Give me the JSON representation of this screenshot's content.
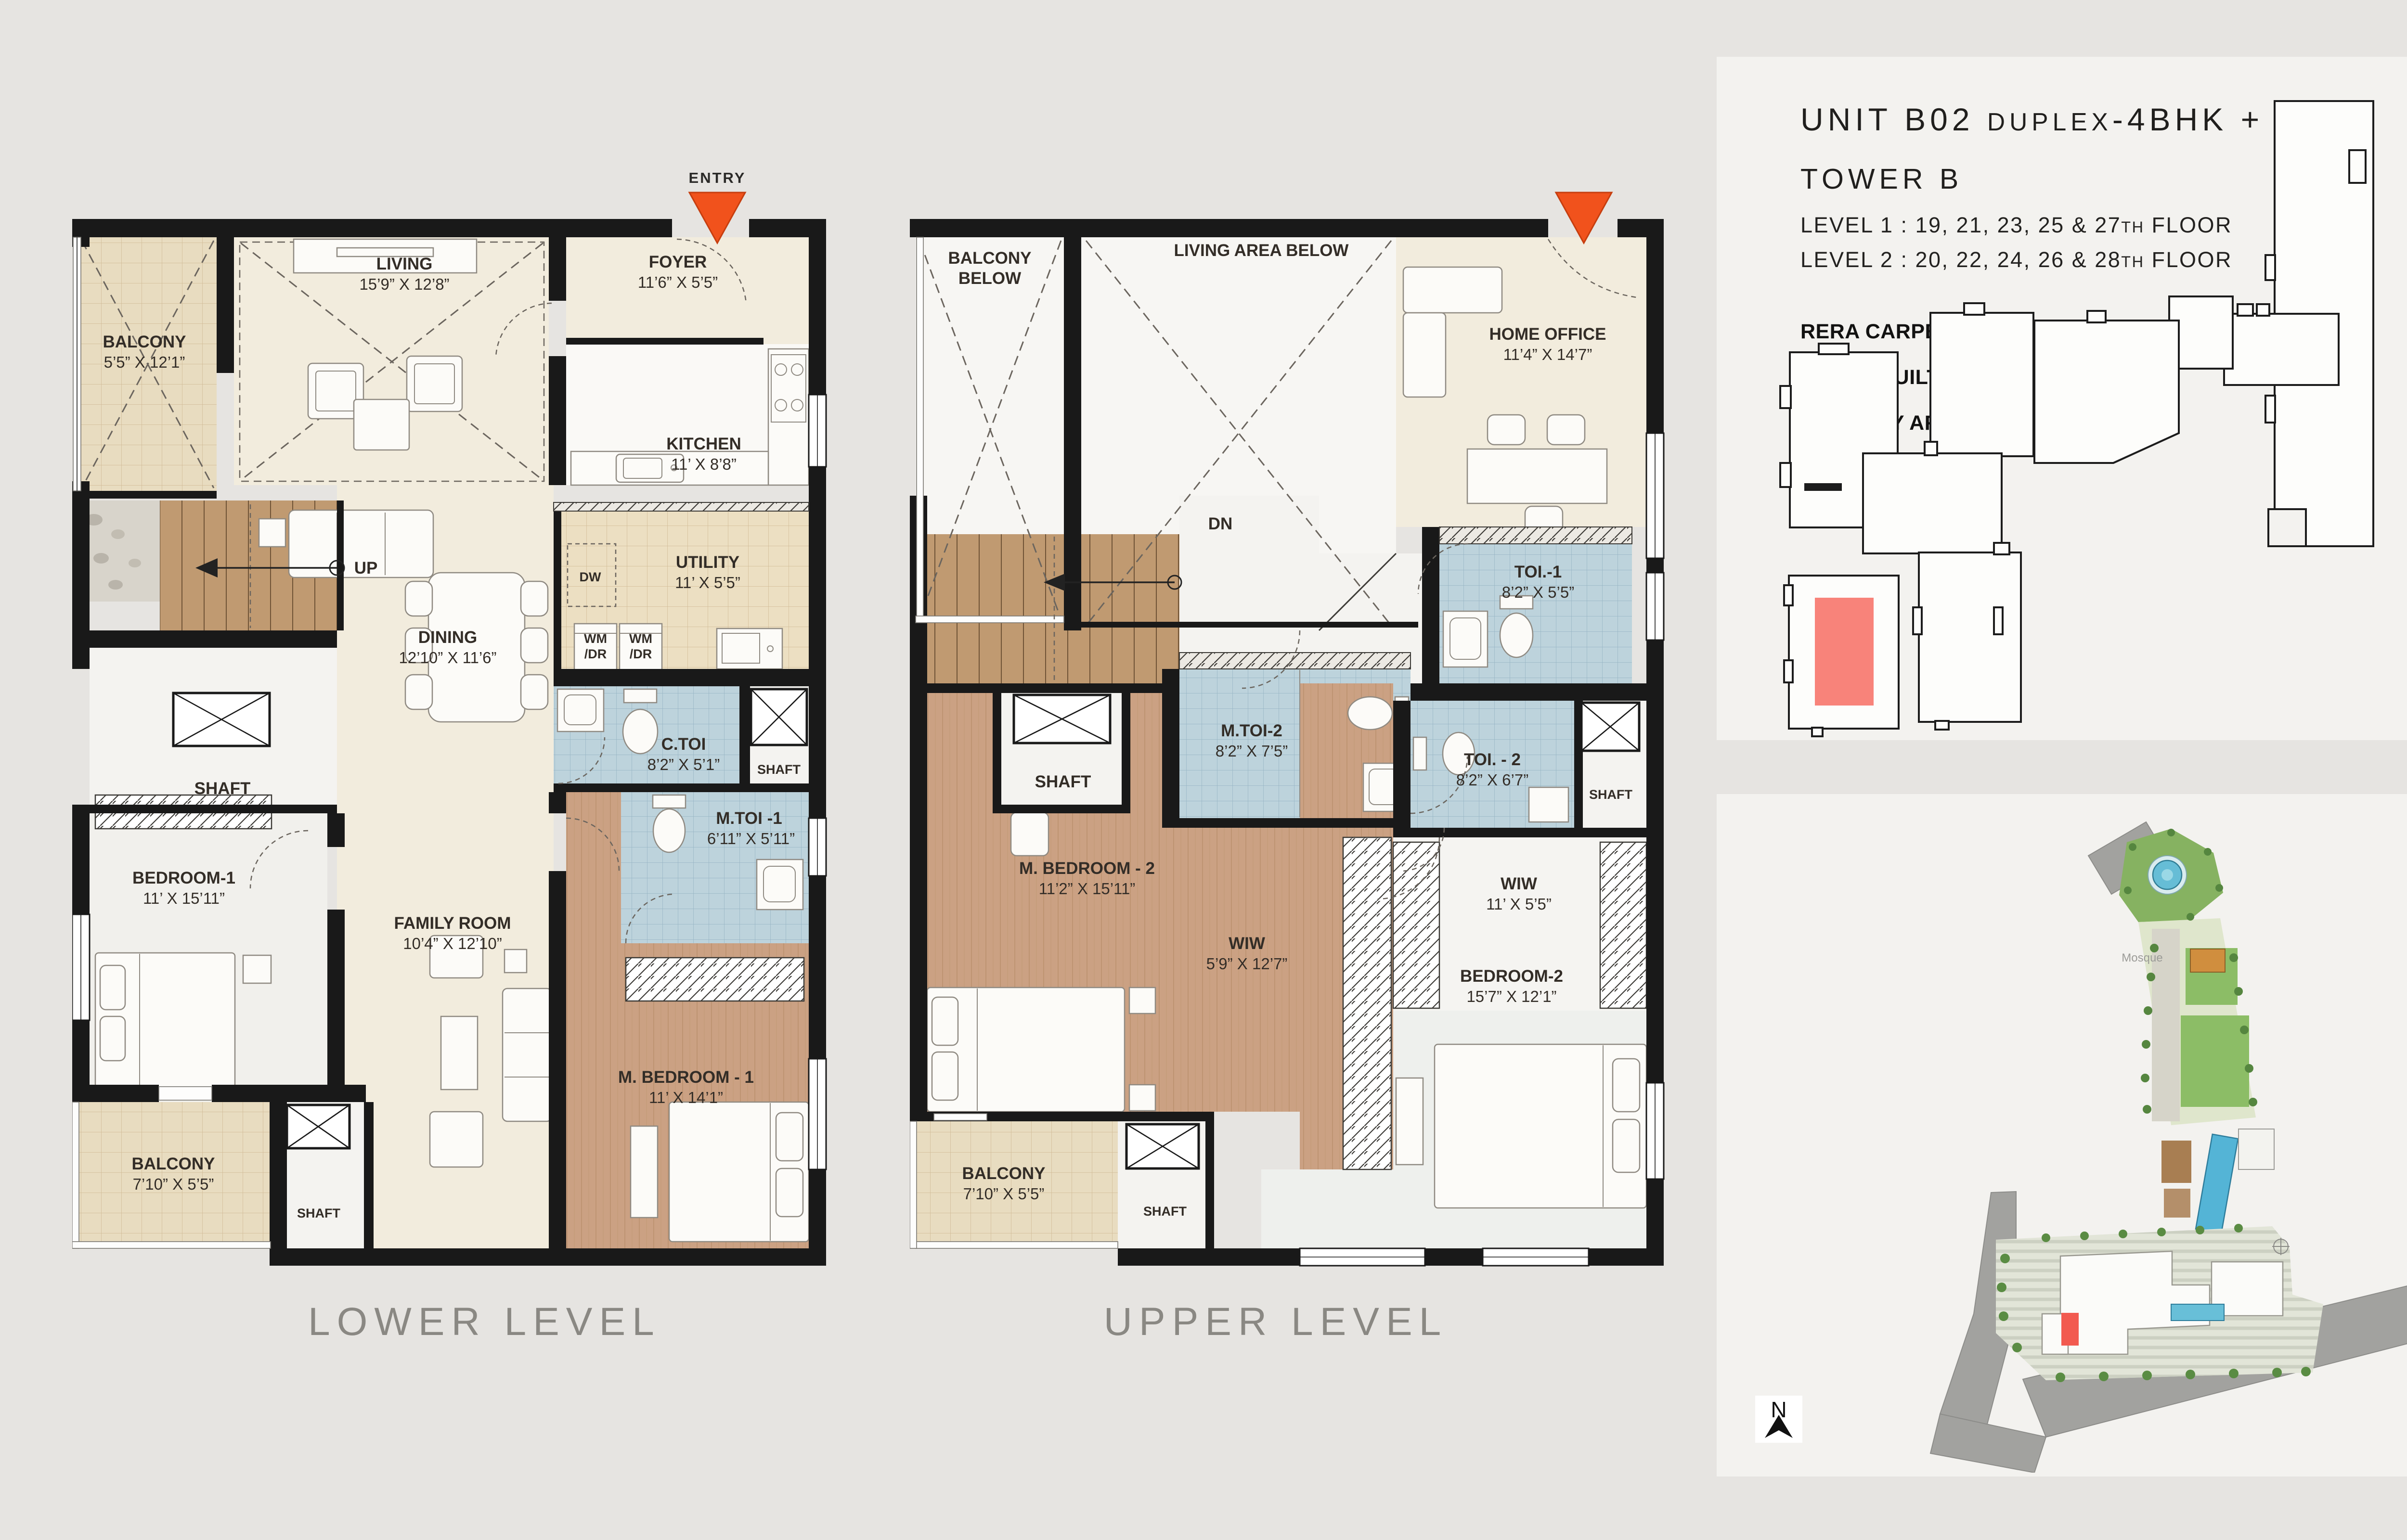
{
  "document": {
    "type": "duplex floor plan brochure page"
  },
  "colors": {
    "background": "#e6e4e1",
    "panel": "#f3f2ef",
    "wall": "#191919",
    "entry_arrow": "#f1521c",
    "unit_highlight": "#f8837a",
    "toilet_tile": "#bdd3dc",
    "wood_floor": "#cba183",
    "beige_floor": "#f2ecdd",
    "title_gray": "#8a8883"
  },
  "lower": {
    "title": "LOWER LEVEL",
    "entry": "ENTRY",
    "stairs": "UP",
    "shaft": "SHAFT",
    "dw": "DW",
    "wm": "WM",
    "dr": "/DR",
    "rooms": {
      "balcony1": {
        "name": "BALCONY",
        "dims": "5’5” X 12’1”"
      },
      "living": {
        "name": "LIVING",
        "dims": "15’9” X 12’8”"
      },
      "foyer": {
        "name": "FOYER",
        "dims": "11’6” X 5’5”"
      },
      "kitchen": {
        "name": "KITCHEN",
        "dims": "11’ X 8’8”"
      },
      "utility": {
        "name": "UTILITY",
        "dims": "11’ X 5’5”"
      },
      "dining": {
        "name": "DINING",
        "dims": "12’10” X 11’6”"
      },
      "ctoi": {
        "name": "C.TOI",
        "dims": "8’2” X 5’1”"
      },
      "mtoi1": {
        "name": "M.TOI -1",
        "dims": "6’11” X 5’11”"
      },
      "bedroom1": {
        "name": "BEDROOM-1",
        "dims": "11’ X 15’11”"
      },
      "family": {
        "name": "FAMILY ROOM",
        "dims": "10’4” X 12’10”"
      },
      "mbedroom1": {
        "name": "M. BEDROOM - 1",
        "dims": "11’ X 14’1”"
      },
      "balcony2": {
        "name": "BALCONY",
        "dims": "7’10” X 5’5”"
      }
    }
  },
  "upper": {
    "title": "UPPER LEVEL",
    "stairs": "DN",
    "shaft": "SHAFT",
    "rooms": {
      "balcony_below": {
        "l1": "BALCONY",
        "l2": "BELOW"
      },
      "living_below": {
        "name": "LIVING AREA BELOW"
      },
      "home_office": {
        "name": "HOME OFFICE",
        "dims": "11’4” X 14’7”"
      },
      "toi1": {
        "name": "TOI.-1",
        "dims": "8’2” X 5’5”"
      },
      "mtoi2": {
        "name": "M.TOI-2",
        "dims": "8’2” X 7’5”"
      },
      "toi2": {
        "name": "TOI. - 2",
        "dims": "8’2” X 6’7”"
      },
      "mbedroom2": {
        "name": "M. BEDROOM - 2",
        "dims": "11’2” X 15’11”"
      },
      "wiw1": {
        "name": "WIW",
        "dims": "5’9” X 12’7”"
      },
      "wiw2": {
        "name": "WIW",
        "dims": "11’ X 5’5”"
      },
      "bedroom2": {
        "name": "BEDROOM-2",
        "dims": "15’7” X 12’1”"
      },
      "balcony": {
        "name": "BALCONY",
        "dims": "7’10” X 5’5”"
      }
    }
  },
  "info": {
    "title_main": "UNIT B02 ",
    "title_small": "DUPLEX",
    "title_rest": "-4BHK + F",
    "tower": "TOWER B",
    "level1_pre": "LEVEL 1  :  19, 21, 23, 25 & 27",
    "level1_sup": "TH",
    "level1_post": " FLOOR",
    "level2_pre": "LEVEL 2  :  20, 22, 24, 26 & 28",
    "level2_sup": "TH",
    "level2_post": " FLOOR",
    "area1": "RERA CARPET AREA : 2522 SQFT",
    "area2": "SUPER BUILT UP AREA : 3848 SQFT",
    "area3": "BALCONY AREA : 149 SQFT"
  },
  "site": {
    "mosque": "Mosque",
    "north": "N"
  }
}
